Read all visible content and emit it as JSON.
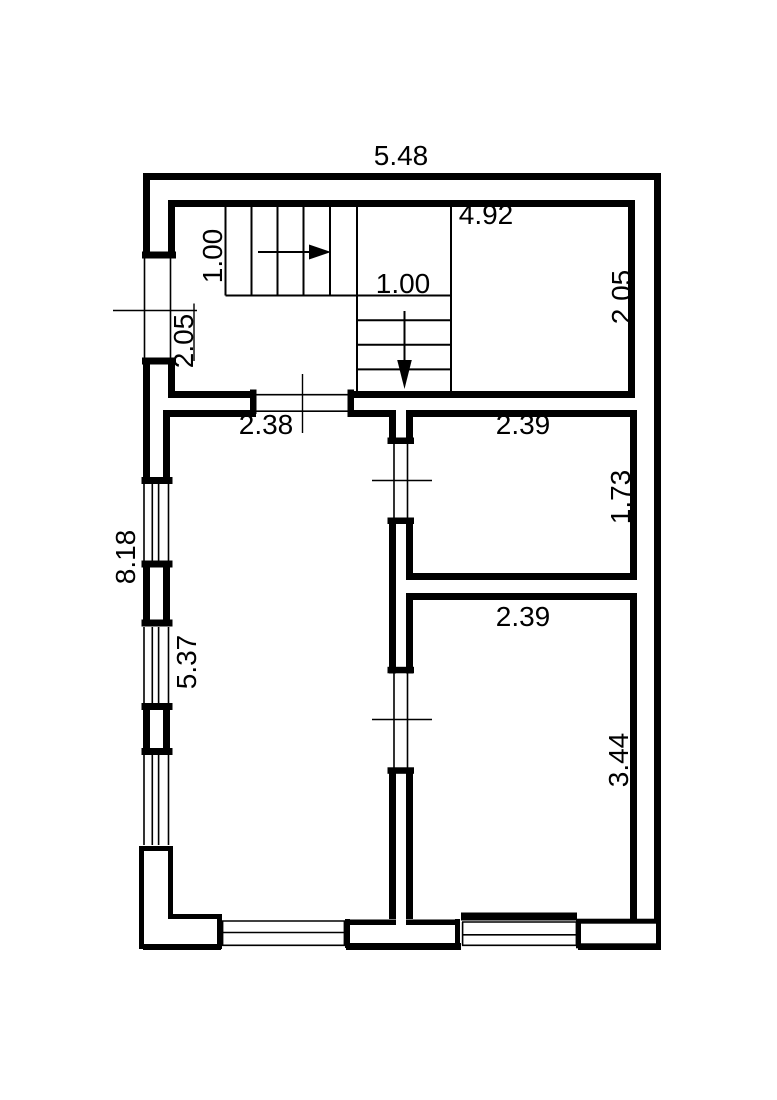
{
  "drawing": {
    "kind": "floor-plan",
    "colors": {
      "line": "#000000",
      "background": "#ffffff"
    }
  },
  "dimensions": {
    "overall_width": "5.48",
    "hall_inner_width": "4.92",
    "stairs_up_width": "1.00",
    "stairs_down_width": "1.00",
    "hall_depth_left": "2.05",
    "hall_depth_right": "2.05",
    "hall_door_offset": "2.38",
    "room1_width": "2.39",
    "room1_depth": "1.73",
    "left_side_total": "8.18",
    "living_room_depth": "5.37",
    "room2_width": "2.39",
    "room2_depth": "3.44"
  }
}
